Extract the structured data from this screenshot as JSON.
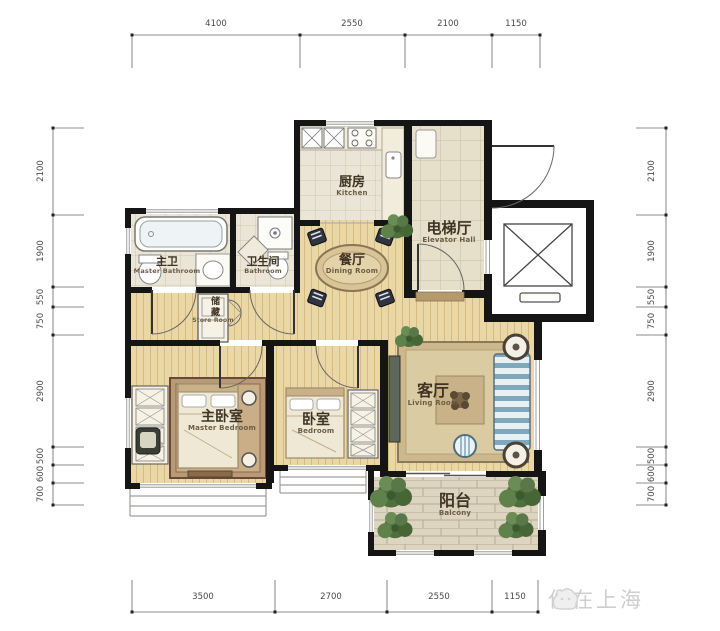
{
  "watermark": {
    "text": "住在上海",
    "logo": "cat-logo"
  },
  "dimensions": {
    "top": [
      "4100",
      "2550",
      "2100",
      "1150"
    ],
    "bottom": [
      "3500",
      "2700",
      "2550",
      "1150"
    ],
    "left": [
      "2100",
      "1900",
      "550",
      "750",
      "2900",
      "500",
      "600",
      "700"
    ],
    "right": [
      "2100",
      "1900",
      "550",
      "750",
      "2900",
      "500",
      "600",
      "700"
    ]
  },
  "rooms": {
    "kitchen": {
      "zh": "厨房",
      "en": "Kitchen"
    },
    "elevator_hall": {
      "zh": "电梯厅",
      "en": "Elevator Hall"
    },
    "dining": {
      "zh": "餐厅",
      "en": "Dining Room"
    },
    "master_bath": {
      "zh": "主卫",
      "en": "Master Bathroom"
    },
    "bathroom": {
      "zh": "卫生间",
      "en": "Bathroom"
    },
    "storage": {
      "zh": "储藏",
      "en": "Store Room"
    },
    "living": {
      "zh": "客厅",
      "en": "Living Room"
    },
    "master_bedroom": {
      "zh": "主卧室",
      "en": "Master Bedroom"
    },
    "bedroom": {
      "zh": "卧室",
      "en": "Bedroom"
    },
    "balcony": {
      "zh": "阳台",
      "en": "Balcony"
    }
  },
  "colors": {
    "wall": "#151515",
    "wood_floor": "#ead7a6",
    "tile_floor": "#eae5d6",
    "balcony_brick": "#ddd5bf",
    "sofa_stripe_blue": "#7fa8bc",
    "plant_green": "#4e6e3e",
    "label_ink": "#3f3323",
    "dimension_text": "#4a4a4a",
    "watermark_gray": "#c6c6c6"
  }
}
